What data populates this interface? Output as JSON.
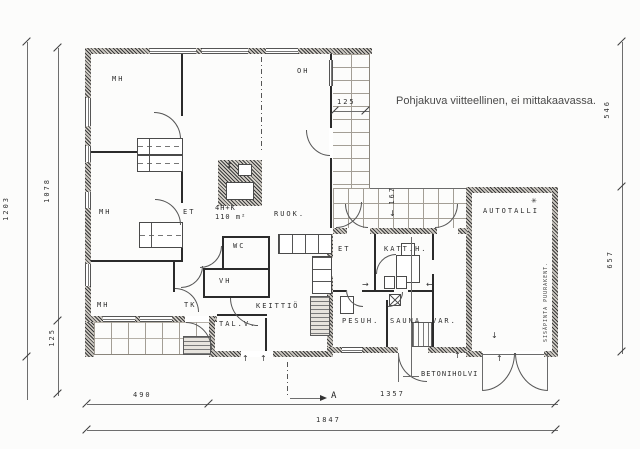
{
  "colors": {
    "ink": "#2b2b2b",
    "paper": "#fcfcfb",
    "wall_fill": "#cfcbc4",
    "grid_gray": "#a39e95",
    "note_gray": "#4a4a4a"
  },
  "note": "Pohjakuva viitteellinen, ei mittakaavassa.",
  "unit": {
    "line1": "4H+K",
    "line2": "110 m²"
  },
  "annotations": {
    "betoniholvi": "BETONIHOLVI",
    "garage_wall_note": "SISÄPINTA PUURAKENT.",
    "section_label": "A",
    "cold_symbol": "✳"
  },
  "rooms": [
    {
      "id": "mh-top",
      "text": "MH",
      "x": 112,
      "y": 76
    },
    {
      "id": "oh",
      "text": "OH",
      "x": 297,
      "y": 68
    },
    {
      "id": "mh-middle",
      "text": "MH",
      "x": 99,
      "y": 209
    },
    {
      "id": "et-hall",
      "text": "ET",
      "x": 183,
      "y": 209
    },
    {
      "id": "ruok",
      "text": "RUOK.",
      "x": 274,
      "y": 211
    },
    {
      "id": "wc",
      "text": "WC",
      "x": 233,
      "y": 243
    },
    {
      "id": "vh",
      "text": "VH",
      "x": 219,
      "y": 278
    },
    {
      "id": "mh-bottom",
      "text": "MH",
      "x": 97,
      "y": 302
    },
    {
      "id": "tk",
      "text": "TK",
      "x": 184,
      "y": 302
    },
    {
      "id": "keittio",
      "text": "KEITTIÖ",
      "x": 256,
      "y": 303
    },
    {
      "id": "tal-v",
      "text": "TAL.V.",
      "x": 219,
      "y": 321
    },
    {
      "id": "et-wing",
      "text": "ET",
      "x": 338,
      "y": 246
    },
    {
      "id": "katt-h",
      "text": "KATT.H.",
      "x": 384,
      "y": 246
    },
    {
      "id": "pesuh",
      "text": "PESUH.",
      "x": 342,
      "y": 318
    },
    {
      "id": "sauna",
      "text": "SAUNA",
      "x": 390,
      "y": 318
    },
    {
      "id": "var",
      "text": "VAR.",
      "x": 432,
      "y": 318
    },
    {
      "id": "autotalli",
      "text": "AUTOTALLI",
      "x": 483,
      "y": 208
    }
  ],
  "dimensions": [
    {
      "id": "left-outer",
      "text": "1203",
      "x": 3,
      "y": 196,
      "vertical": true
    },
    {
      "id": "left-inner",
      "text": "1078",
      "x": 44,
      "y": 178,
      "vertical": true
    },
    {
      "id": "left-lower",
      "text": "125",
      "x": 49,
      "y": 328,
      "vertical": true
    },
    {
      "id": "right-upper",
      "text": "546",
      "x": 604,
      "y": 100,
      "vertical": true
    },
    {
      "id": "right-lower",
      "text": "657",
      "x": 607,
      "y": 250,
      "vertical": true
    },
    {
      "id": "top-right",
      "text": "125",
      "x": 337,
      "y": 99,
      "vertical": false
    },
    {
      "id": "terrace",
      "text": "167",
      "x": 389,
      "y": 186,
      "vertical": true
    },
    {
      "id": "bottom-left",
      "text": "490",
      "x": 133,
      "y": 392,
      "vertical": false
    },
    {
      "id": "bottom-mid",
      "text": "1357",
      "x": 380,
      "y": 391,
      "vertical": false
    },
    {
      "id": "bottom-total",
      "text": "1847",
      "x": 316,
      "y": 417,
      "vertical": false
    }
  ],
  "arrows": [
    {
      "id": "entry-up-1",
      "glyph": "↑",
      "x": 242,
      "y": 355
    },
    {
      "id": "entry-up-2",
      "glyph": "↑",
      "x": 260,
      "y": 355
    },
    {
      "id": "entry-up-3",
      "glyph": "↑",
      "x": 454,
      "y": 352
    },
    {
      "id": "garage-up",
      "glyph": "↑",
      "x": 496,
      "y": 355
    },
    {
      "id": "garage-down",
      "glyph": "↓",
      "x": 491,
      "y": 332
    },
    {
      "id": "var-left",
      "glyph": "←",
      "x": 426,
      "y": 281
    },
    {
      "id": "et2-right",
      "glyph": "→",
      "x": 362,
      "y": 281
    },
    {
      "id": "flue-updown",
      "glyph": "↕",
      "x": 226,
      "y": 162
    },
    {
      "id": "dim167-down",
      "glyph": "↓",
      "x": 389,
      "y": 210
    }
  ]
}
